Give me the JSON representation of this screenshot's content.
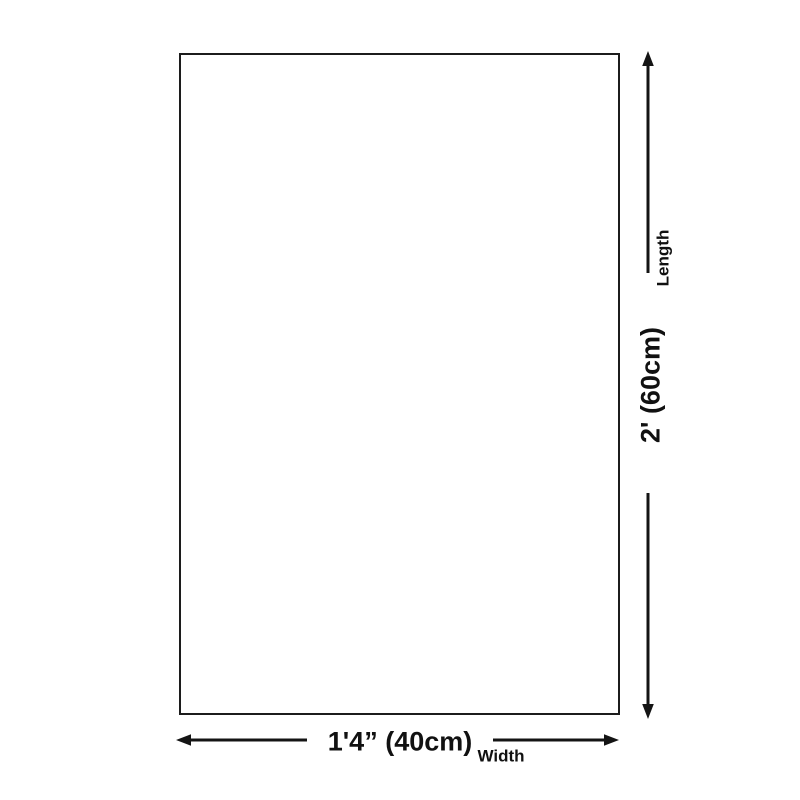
{
  "background_color": "#ffffff",
  "diagram": {
    "shape": "rectangle-outline",
    "rect_border_color": "#1c1c1c",
    "arrow_color": "#141414",
    "text_color": "#111111",
    "length": {
      "label": "Length",
      "value": "2' (60cm)"
    },
    "width": {
      "label": "Width",
      "value": "1'4” (40cm)"
    }
  }
}
